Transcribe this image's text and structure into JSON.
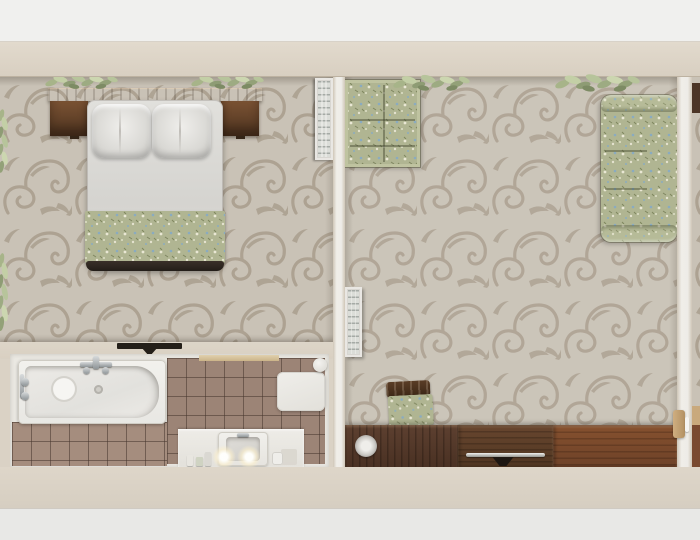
{
  "scene": {
    "description": "Top-down 3D architectural render of a furnished apartment with bedroom, bathroom and living room",
    "width_px": 700,
    "height_px": 540
  },
  "palette": {
    "outer_wall_white": "#f0f0ee",
    "wall_beige": "#d8cfc1",
    "wallpaper_background": "#c9c2b6",
    "wallpaper_scroll": "#a89c8c",
    "wood_dark": "#5f4026",
    "wood_reddish": "#7b4a2f",
    "fabric_sage_green": "#b0b592",
    "fabric_blue_fleck": "#8aabc0",
    "tile_brown": "#9c8476",
    "tile_grout": "#7b685c",
    "linen_white": "#dcdbd7",
    "chrome": "#9aa0a2"
  },
  "rooms": {
    "bedroom": {
      "label": "Bedroom",
      "items": {
        "headboard": "Dark wood headboard shelf with nightstands",
        "bed": "Double bed with white linens",
        "pillows": "Two white pillows",
        "blanket": "Sage green floral blanket",
        "ac": "Wall ventilation grille",
        "plants": "Green plants on headboard and left wall",
        "door": "Door opening to bathroom"
      }
    },
    "bathroom": {
      "label": "Bathroom",
      "items": {
        "bathtub": "White bathtub with chrome faucet",
        "tiles": "Brown ceramic tile floor",
        "mat": "White bath mat",
        "roll": "Towel roll",
        "vanity": "Vanity counter",
        "sink": "Washbasin",
        "candles": "Two lit candles",
        "toiletries": "Bottles and jar"
      }
    },
    "living": {
      "label": "Living room",
      "items": {
        "loveseat": "Green floral loveseat",
        "sofa": "Green floral three-seat sofa",
        "radiator": "White radiator grille",
        "chair": "Wood side chair with floral cushion",
        "credenza": "Long dark wood credenza",
        "plants": "Green plants along top wall"
      }
    },
    "adjacent": {
      "label": "Adjacent room sliver"
    }
  }
}
